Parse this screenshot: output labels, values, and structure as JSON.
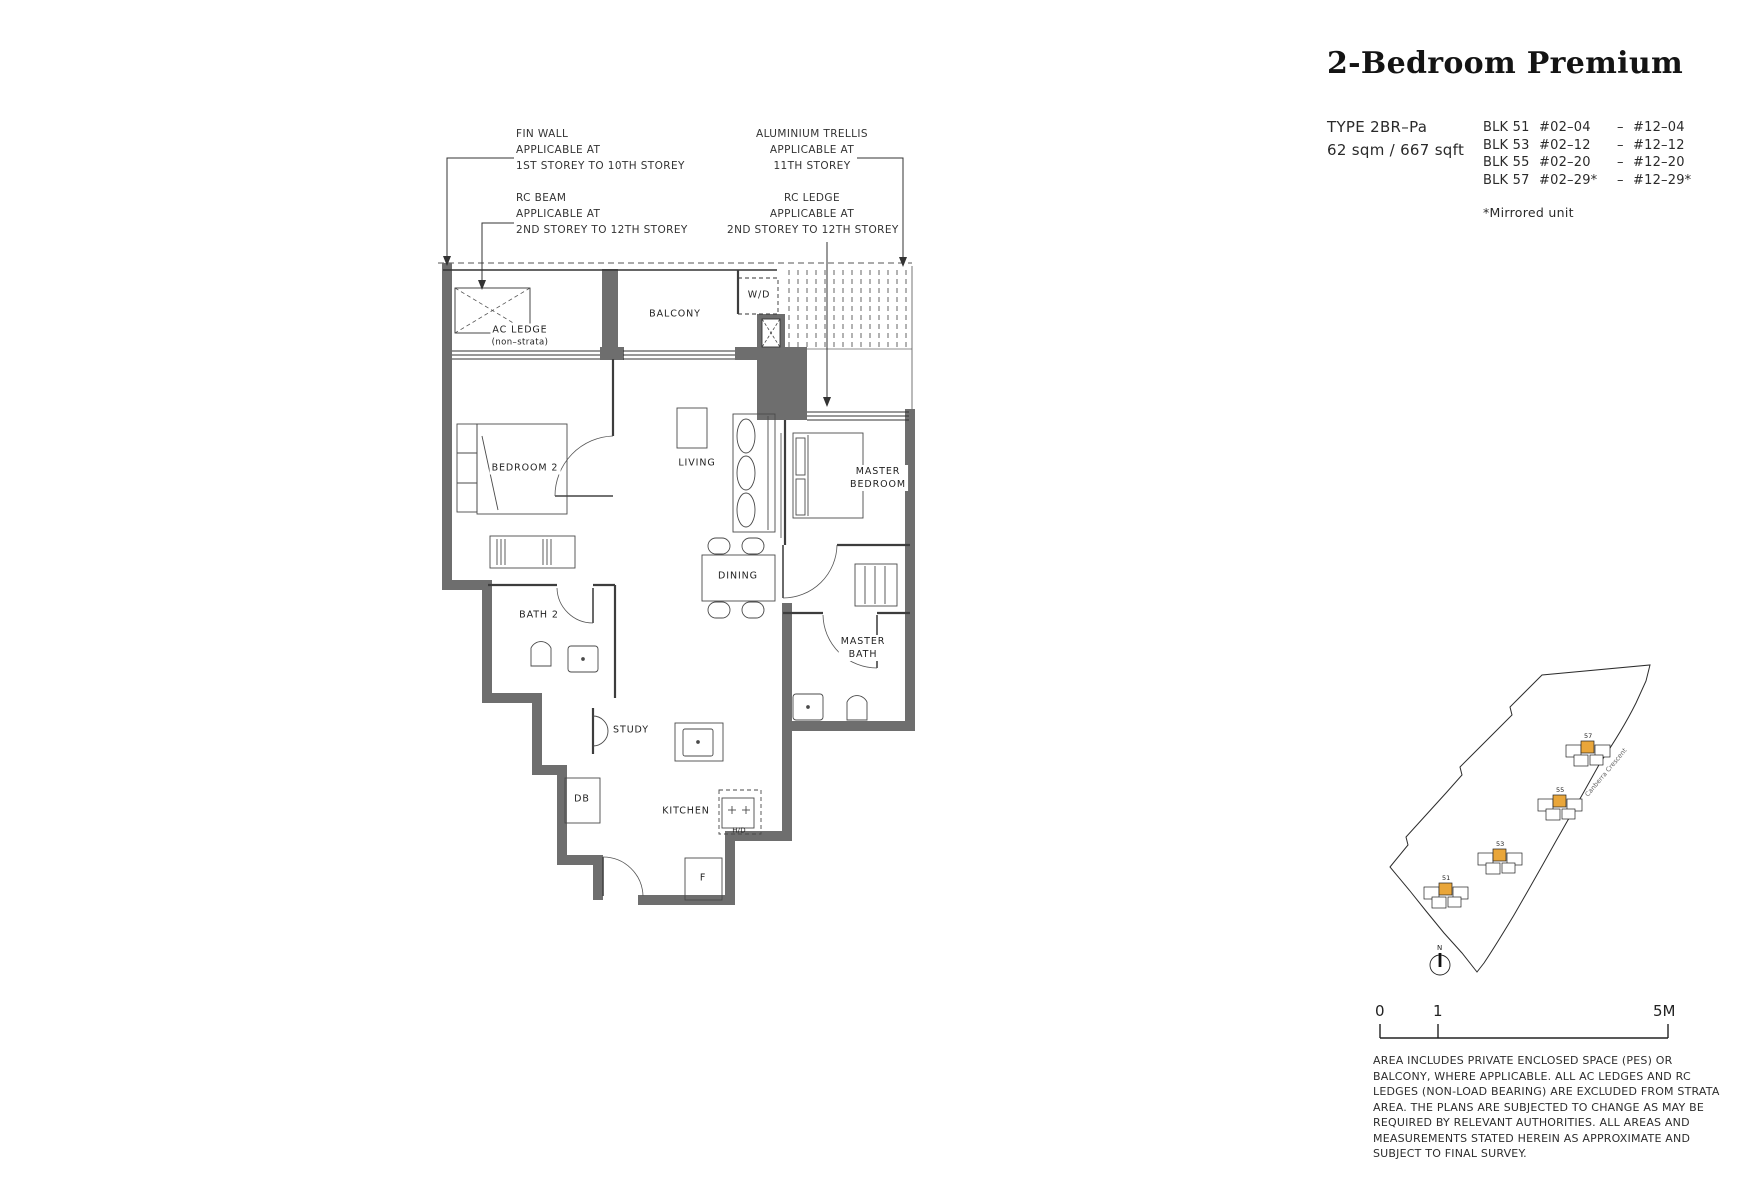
{
  "meta": {
    "colors": {
      "wall": "#6e6e6e",
      "highlight_yellow": "#E9A63A",
      "ink": "#222222"
    }
  },
  "header": {
    "title": "2-Bedroom Premium",
    "type_label": "TYPE 2BR–Pa",
    "area": "62 sqm / 667 sqft",
    "blocks": [
      {
        "blk": "BLK 51",
        "from": "#02–04",
        "sep": "–",
        "to": "#12–04"
      },
      {
        "blk": "BLK 53",
        "from": "#02–12",
        "sep": "–",
        "to": "#12–12"
      },
      {
        "blk": "BLK 55",
        "from": "#02–20",
        "sep": "–",
        "to": "#12–20"
      },
      {
        "blk": "BLK 57",
        "from": "#02–29*",
        "sep": "–",
        "to": "#12–29*"
      }
    ],
    "mirror_note": "*Mirrored unit"
  },
  "annotations": {
    "fin_wall": [
      "FIN WALL",
      "APPLICABLE AT",
      "1ST STOREY TO 10TH  STOREY"
    ],
    "rc_beam": [
      "RC BEAM",
      "APPLICABLE AT",
      "2ND STOREY TO 12TH  STOREY"
    ],
    "trellis": [
      "ALUMINIUM TRELLIS",
      "APPLICABLE AT",
      "11TH STOREY"
    ],
    "rc_ledge": [
      "RC LEDGE",
      "APPLICABLE AT",
      "2ND STOREY TO 12TH STOREY"
    ]
  },
  "plan": {
    "rooms": {
      "ac_ledge": "AC LEDGE",
      "ac_ledge_sub": "(non–strata)",
      "balcony": "BALCONY",
      "wd": "W/D",
      "bedroom2": "BEDROOM 2",
      "living": "LIVING",
      "master_1": "MASTER",
      "master_2": "BEDROOM",
      "bath2": "BATH 2",
      "dining": "DINING",
      "master_bath_1": "MASTER",
      "master_bath_2": "BATH",
      "study": "STUDY",
      "db": "DB",
      "kitchen": "KITCHEN",
      "fridge": "F",
      "hob": "H/D"
    }
  },
  "site_map": {
    "block_51": "51",
    "block_53": "53",
    "block_55": "55",
    "block_57": "57",
    "road": "Canberra Crescent",
    "north": "N"
  },
  "scale_bar": {
    "zero": "0",
    "one": "1",
    "five": "5M"
  },
  "disclaimer": "AREA INCLUDES PRIVATE ENCLOSED SPACE (PES) OR BALCONY, WHERE APPLICABLE. ALL AC LEDGES AND RC LEDGES (NON-LOAD BEARING) ARE EXCLUDED FROM STRATA AREA. THE PLANS ARE SUBJECTED TO CHANGE AS MAY BE REQUIRED BY RELEVANT AUTHORITIES. ALL AREAS AND MEASUREMENTS STATED HEREIN AS APPROXIMATE AND SUBJECT TO FINAL SURVEY."
}
